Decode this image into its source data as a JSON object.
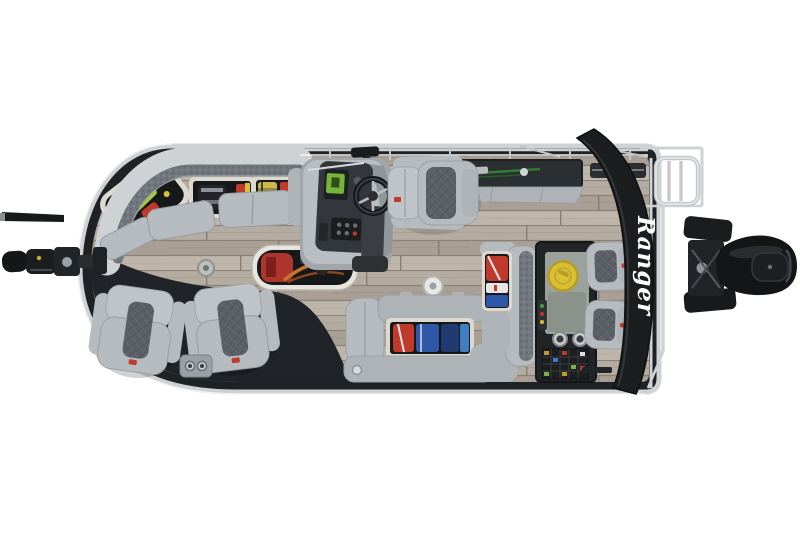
{
  "scene": {
    "description": "Overhead top-down product photo of a Ranger pontoon fishing boat on a white background, bow at left with trolling motor, stern at right with black outboard motor and folded bimini top",
    "background_color": "#ffffff"
  },
  "branding": {
    "bimini_logo_text": "Ranger",
    "bimini_logo_color": "#ffffff",
    "seat_badge_color": "#b33028"
  },
  "colors": {
    "bg": "#ffffff",
    "trim": "#1f2224",
    "dark": "#202327",
    "rail": "#cfd2d5",
    "railhi": "#f2f3f4",
    "floorA": "#b5aca1",
    "floorB": "#a99f94",
    "floorC": "#bfb6ab",
    "floorSeam": "#8a8177",
    "seat": "#b6bbc0",
    "seat2": "#aeb3b8",
    "seat3": "#bfc4c9",
    "seatedge": "#989ea3",
    "insert": "#5a6066",
    "rim": "#ddd8d0",
    "hold": "#17181a",
    "yellow": "#d9bf35",
    "red": "#bf392d",
    "blue": "#2f57a8",
    "navy": "#203a72",
    "lime": "#a4cf3b",
    "orange": "#c06a2c",
    "rodgreen": "#2f7d32",
    "console": "#b9bec3",
    "dash": "#33373b",
    "bimini": "#1b1d1f",
    "motor": "#131517",
    "logo": "#ffffff"
  },
  "boat": {
    "fishing_chair_count": 2,
    "jump_seat_count": 2,
    "cup_holder_count": 4,
    "deck_drain_count": 2,
    "features": [
      "bow-trolling-motor",
      "port-bow-storage-couch",
      "under-seat-storage-open",
      "in-floor-rod-locker",
      "helm-console",
      "steering-wheel",
      "captain-chair",
      "port-rod-storage-box",
      "starboard-lounge-bench",
      "stern-l-bench",
      "life-jacket-storage",
      "stern-bait-station",
      "livewell-lid",
      "cup-holders",
      "tackle-trays",
      "stern-jump-seats",
      "folded-bimini-top",
      "boarding-ladder",
      "stern-rails",
      "outboard-motor",
      "bow-fishing-chairs",
      "cup-holder-pedestal",
      "deck-drains",
      "wood-look-vinyl-floor"
    ]
  }
}
